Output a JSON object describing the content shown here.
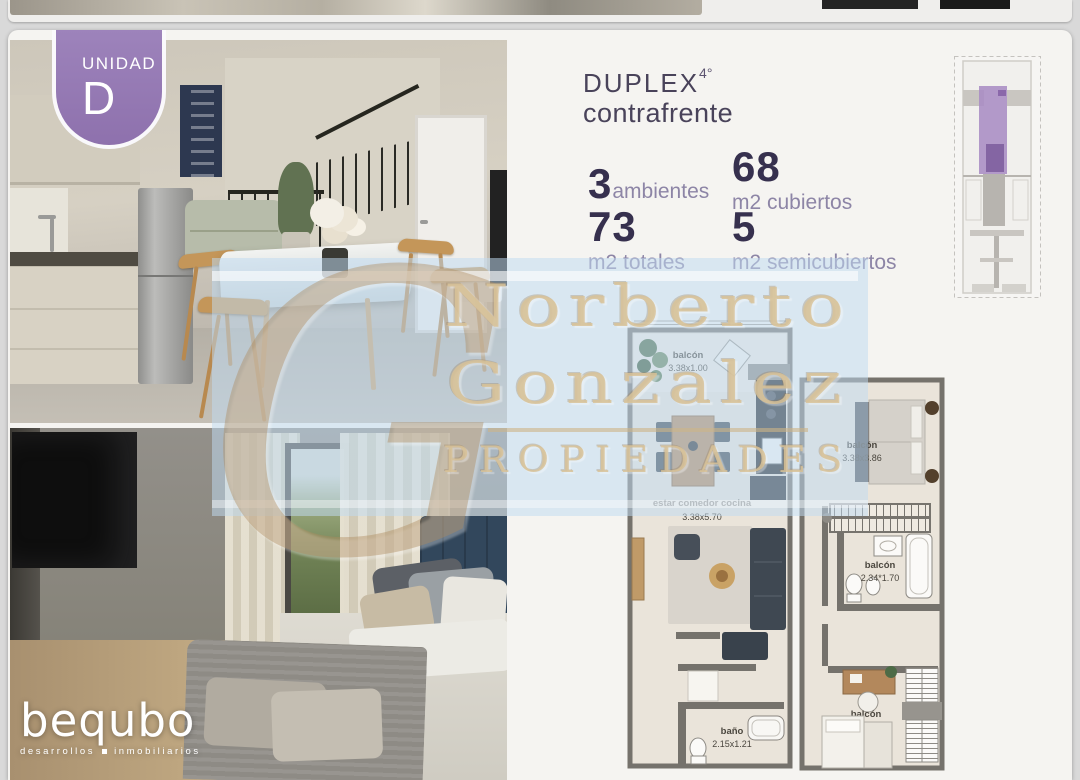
{
  "badge": {
    "label": "UNIDAD",
    "letter": "D"
  },
  "title": {
    "name": "DUPLEX",
    "floor": "4°",
    "subtitle": "contrafrente"
  },
  "stats": {
    "ambientes": {
      "value": "3",
      "label": "ambientes"
    },
    "cubiertos": {
      "value": "68",
      "label": "m2 cubiertos"
    },
    "totales": {
      "value": "73",
      "label": "m2 totales"
    },
    "semicubiertos": {
      "value": "5",
      "label": "m2 semicubiertos"
    }
  },
  "floorplan": {
    "lower": {
      "balcony": {
        "name": "balcón",
        "dims": "3.38x1.00"
      },
      "living": {
        "name": "estar comedor cocina",
        "dims": "3.38x5.70"
      },
      "bath": {
        "name": "baño",
        "dims": "2.15x1.21"
      }
    },
    "upper": {
      "bedroom": {
        "name": "balcón",
        "dims": "3.38x3.86"
      },
      "bath": {
        "name": "balcón",
        "dims": "2.34*1.70"
      },
      "studio": {
        "name": "balcón",
        "dims": "3.38x2.49"
      }
    }
  },
  "watermark": {
    "monogram": "G",
    "line1": "Norberto",
    "line2": "Gonzalez",
    "line3": "PROPIEDADES"
  },
  "logo": {
    "name": "bequbo",
    "tagline_left": "desarrollos",
    "tagline_right": "inmobiliarios"
  },
  "colors": {
    "accent_purple": "#9678b4",
    "number_dark": "#36304e",
    "label_purple": "#8d85a6",
    "watermark_blue": "#bfdbf1",
    "watermark_tan": "#c8a87a",
    "plan_wall": "#75726c",
    "plan_floor": "#eae4da"
  }
}
